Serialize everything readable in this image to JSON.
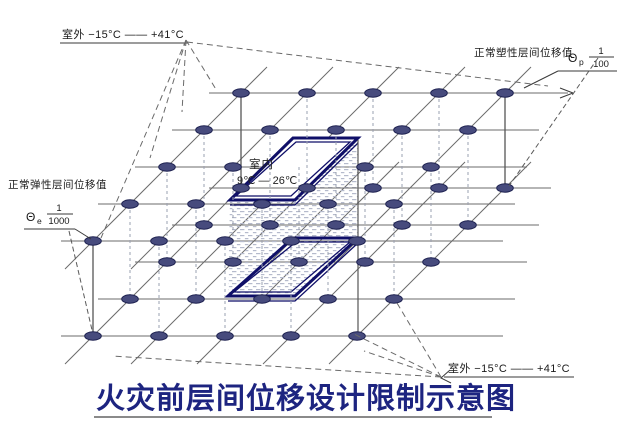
{
  "labels": {
    "outdoor_top": "室外  −15°C —— +41°C",
    "outdoor_bottom": "室外  −15°C —— +41°C",
    "plastic": "正常塑性层间位移值",
    "elastic": "正常弹性层间位移值",
    "theta_p": {
      "symbol": "Θ",
      "sub": "p",
      "num": "1",
      "den": "100"
    },
    "theta_e": {
      "symbol": "Θ",
      "sub": "e",
      "num": "1",
      "den": "1000"
    },
    "indoor": {
      "name": "室内",
      "range": "9℃ — 26℃"
    },
    "title": "火灾前层间位移设计限制示意图"
  },
  "colors": {
    "slab_border": "#0f0f68",
    "grid_line": "#6b6b6b",
    "node_fill": "#474b7d",
    "node_stroke": "#1d2150",
    "hatch": "#b5bacc",
    "title": "#1d2480"
  }
}
